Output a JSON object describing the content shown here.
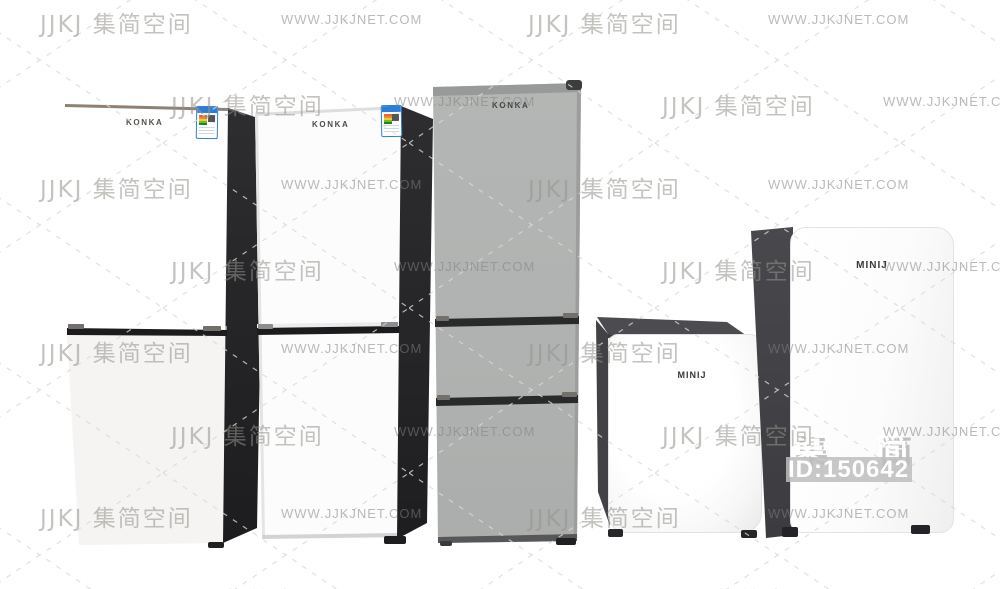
{
  "canvas": {
    "width": 1000,
    "height": 589,
    "background": "#ffffff"
  },
  "watermark": {
    "brand_text": "JJKJ 集简空间",
    "site_text": "WWW.JJKJNET.COM"
  },
  "overlay": {
    "brand_large": "集 简",
    "model_id": "ID:150642"
  },
  "products": [
    {
      "brand": "KONKA",
      "face_color": "#c6b5a6"
    },
    {
      "brand": "KONKA",
      "face_color": "#fbfbfb"
    },
    {
      "brand": "KONKA",
      "face_color": "#b5b7b6"
    },
    {
      "brand": "MINIJ",
      "face_color": "#fcfcfc"
    },
    {
      "brand": "MINIJ",
      "face_color": "#fcfcfc"
    }
  ],
  "colors": {
    "dark_side": "#2a2a2c",
    "minij_dark": "#47474b",
    "label_blue": "#2f7cd6",
    "id_band": "#bdbdbd",
    "watermark_gray": "#a8a8a8",
    "dash_gray": "#d9d9d9"
  }
}
